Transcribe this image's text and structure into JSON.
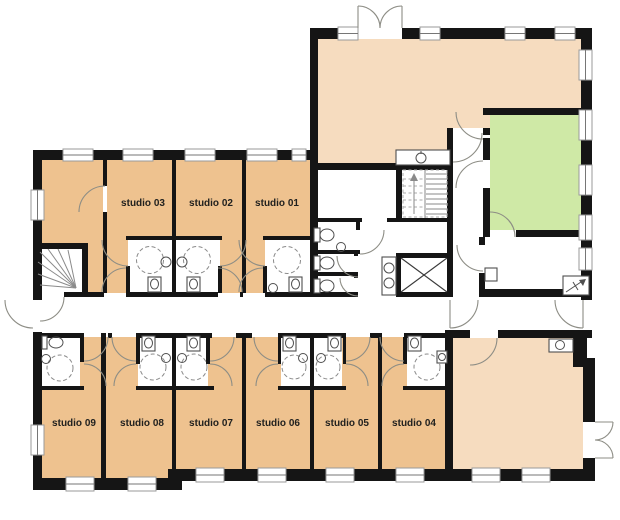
{
  "plan": {
    "title": "Studio floor plan",
    "rooms": {
      "studio01": {
        "label": "studio 01"
      },
      "studio02": {
        "label": "studio 02"
      },
      "studio03": {
        "label": "studio 03"
      },
      "studio04": {
        "label": "studio 04"
      },
      "studio05": {
        "label": "studio 05"
      },
      "studio06": {
        "label": "studio 06"
      },
      "studio07": {
        "label": "studio 07"
      },
      "studio08": {
        "label": "studio 08"
      },
      "studio09": {
        "label": "studio 09"
      }
    }
  },
  "colors": {
    "studio": "#eec28f",
    "common": "#f6dcbf",
    "green": "#cfe9a6",
    "wall": "#151515",
    "floor": "#ffffff"
  }
}
